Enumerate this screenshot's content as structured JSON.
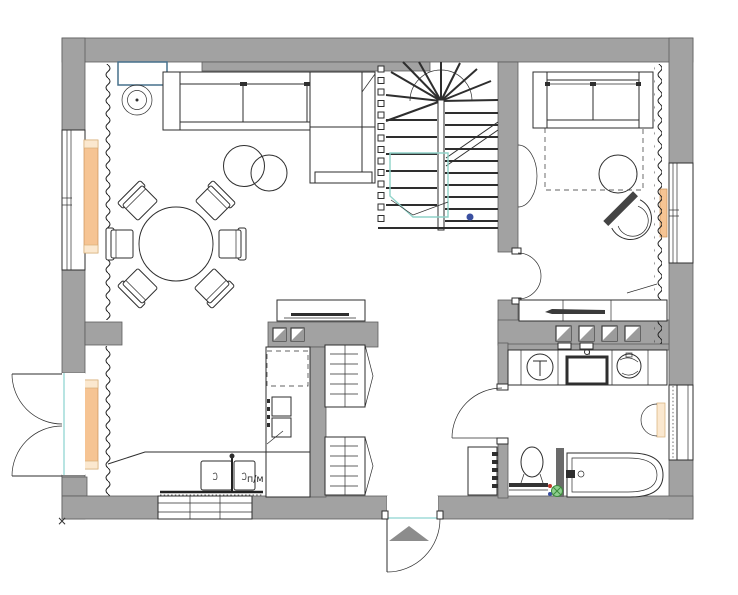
{
  "title": "apartment-floor-plan",
  "canvas": {
    "width": 738,
    "height": 595
  },
  "labels": {
    "dishwasher": "п/м",
    "corner_marker": "×"
  },
  "colors": {
    "wall": "#a2a2a2",
    "line": "#2e2e2e",
    "radiator": "#f6c493",
    "radiator_cap": "#fbe8cf",
    "accent_teal": "#8fd2c8",
    "threshold": "#b8e4e2",
    "console_blue": "#46708c",
    "drain_green": "#8fcf8f",
    "drain_green_dark": "#3d8b3d",
    "dot_red": "#c0392b",
    "dot_blue": "#3a4fa0",
    "entrance_arrow": "#8c8c8c",
    "vent_gray": "#9b9b9b"
  },
  "plan": {
    "stairs": {
      "flights": 2,
      "balusters": 14
    },
    "rooms": [
      {
        "name": "living-dining",
        "symbols": [
          "corner-sofa",
          "chaise",
          "coffee-tables",
          "round-dining-table",
          "six-chairs",
          "plant",
          "tv-cabinet",
          "wall-console",
          "window",
          "radiator",
          "curtain-zigzag"
        ]
      },
      {
        "name": "kitchen",
        "symbols": [
          "l-shaped-counter",
          "double-sink",
          "dishwasher-label",
          "fridge-dashed",
          "oven-stack",
          "radiator",
          "french-door",
          "bottom-window"
        ]
      },
      {
        "name": "bedroom",
        "symbols": [
          "sofa-bed",
          "fold-out-bed-dashed",
          "pouf",
          "tub-armchair",
          "half-round-desk",
          "desk-row",
          "window",
          "radiator",
          "curtain-zigzag",
          "swing-door"
        ]
      },
      {
        "name": "bathroom",
        "symbols": [
          "washing-machine",
          "counter-sink",
          "dryer",
          "towel-radiator",
          "toilet",
          "bathtub",
          "floor-drain",
          "frosted-window",
          "swing-door"
        ]
      },
      {
        "name": "hall",
        "symbols": [
          "staircase",
          "wardrobe-upper",
          "wardrobe-lower",
          "entry-cabinet",
          "entrance-door",
          "entrance-arrow"
        ]
      }
    ]
  }
}
